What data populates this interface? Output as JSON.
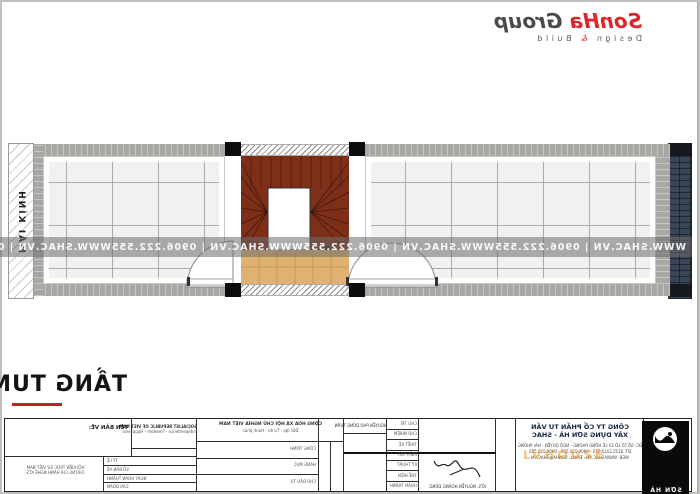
{
  "brand": {
    "name": "SonHa",
    "suffix": "Group",
    "tagline_design": "Design",
    "tagline_amp": "&",
    "tagline_build": "Build",
    "red": "#E0242A",
    "gray": "#4A4A4A"
  },
  "plan": {
    "glass_roof_label": "MÁI KÍNH",
    "watermark": "WWW.SHAC.VN  |  0906.222.555"
  },
  "floor_title": {
    "text": "TẦNG TUM"
  },
  "title_block": {
    "drawing_name_label": "TÊN BẢN VẼ:",
    "motto_en": [
      "SOCIALIST REPUBLIC OF VIET NAM",
      "Independence - Freedom - Happiness"
    ],
    "motto_vn": [
      "CỘNG HÒA XÃ HỘI CHỦ NGHĨA VIỆT NAM",
      "Độc lập - Tự do - Hạnh phúc"
    ],
    "cert": [
      "HỘI KIẾN TRÚC SƯ VIỆT NAM",
      "CHỨNG CHỈ HÀNH NGHỀ KTS"
    ],
    "left_rows": [
      "TỶ LỆ",
      "SỐ BẢN VẼ",
      "NGÀY HOÀN THÀNH",
      "GIAI ĐOẠN"
    ],
    "mid_rows": [
      "CÔNG TRÌNH",
      "HẠNG MỤC",
      "CHỦ ĐẦU TƯ"
    ],
    "client_name": "NGUYỄN PHÚ DŨNG TUẤN",
    "stage_rows": [
      "CHỦ TRÌ",
      "CHỦ NHIỆM",
      "THIẾT KẾ",
      "KIỂM TRA",
      "KỸ THUẬT",
      "THỂ HIỆN",
      "HOÀN THÀNH"
    ],
    "architect": "KTS. NGUYỄN HOÀNG DŨNG",
    "company_line1": "CÔNG TY CỔ PHẦN TƯ VẤN",
    "company_line2": "XÂY DỰNG SƠN HÀ - SHAC",
    "company_address": "ĐC: SỐ 55 LÔ 22 LÊ HỒNG PHONG - NGÔ QUYỀN - HẢI PHÒNG",
    "company_phone": "ĐT: 0225.2222.555 - 0906.222.555 - 0906.222.555",
    "company_web": "WEB: WWW.SHAC.VN - EMAIL: SONHA@SHAC.VN",
    "logo_text": "SƠN HÀ"
  },
  "overlay_watermark": {
    "text": "LVHOUSE",
    "color": "#F59A23"
  }
}
